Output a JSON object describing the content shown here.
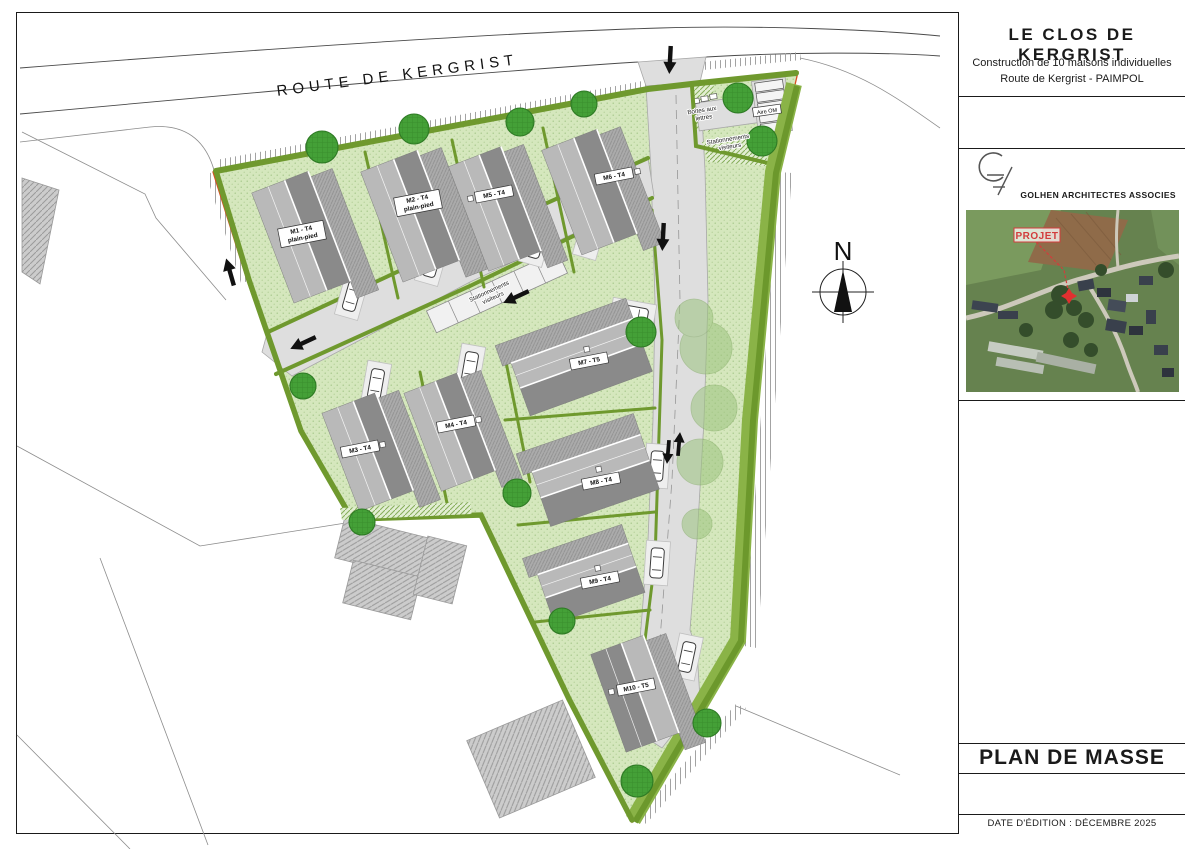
{
  "title_block": {
    "project_title": "LE CLOS DE KERGRIST",
    "subtitle_line1": "Construction de 10 maisons individuelles",
    "subtitle_line2": "Route de Kergrist - PAIMPOL",
    "architect": "GOLHEN ARCHITECTES ASSOCIES",
    "photo_label": "PROJET",
    "drawing_title": "PLAN DE MASSE",
    "edition_date": "DATE D'ÉDITION : DÉCEMBRE 2025"
  },
  "map": {
    "road_label": "ROUTE DE KERGRIST",
    "north_label": "N",
    "houses": [
      {
        "id": "M1",
        "label": "M1 - T4",
        "sub": "plain-pied"
      },
      {
        "id": "M2",
        "label": "M2 - T4",
        "sub": "plain-pied"
      },
      {
        "id": "M3",
        "label": "M3 - T4",
        "sub": ""
      },
      {
        "id": "M4",
        "label": "M4 - T4",
        "sub": ""
      },
      {
        "id": "M5",
        "label": "M5 - T4",
        "sub": ""
      },
      {
        "id": "M6",
        "label": "M6 - T4",
        "sub": ""
      },
      {
        "id": "M7",
        "label": "M7 - T5",
        "sub": ""
      },
      {
        "id": "M8",
        "label": "M8 - T4",
        "sub": ""
      },
      {
        "id": "M9",
        "label": "M9 - T4",
        "sub": ""
      },
      {
        "id": "M10",
        "label": "M10 - T5",
        "sub": ""
      }
    ],
    "annotations": {
      "mailboxes_line1": "Boîtes aux",
      "mailboxes_line2": "lettres",
      "visitor_parking_line1": "Stationnements",
      "visitor_parking_line2": "visiteurs",
      "waste_area": "Aire OM"
    },
    "colors": {
      "site_green": "#d5e7bd",
      "hedge_green": "#6f992e",
      "hedge_band": "#8ab347",
      "road_gray": "#dedede",
      "roof_light": "#b9b9b9",
      "roof_dark": "#8a8a8a",
      "boundary_red": "#d84e22",
      "tree_green": "#44a037",
      "marker_red": "#d23c3c"
    }
  }
}
